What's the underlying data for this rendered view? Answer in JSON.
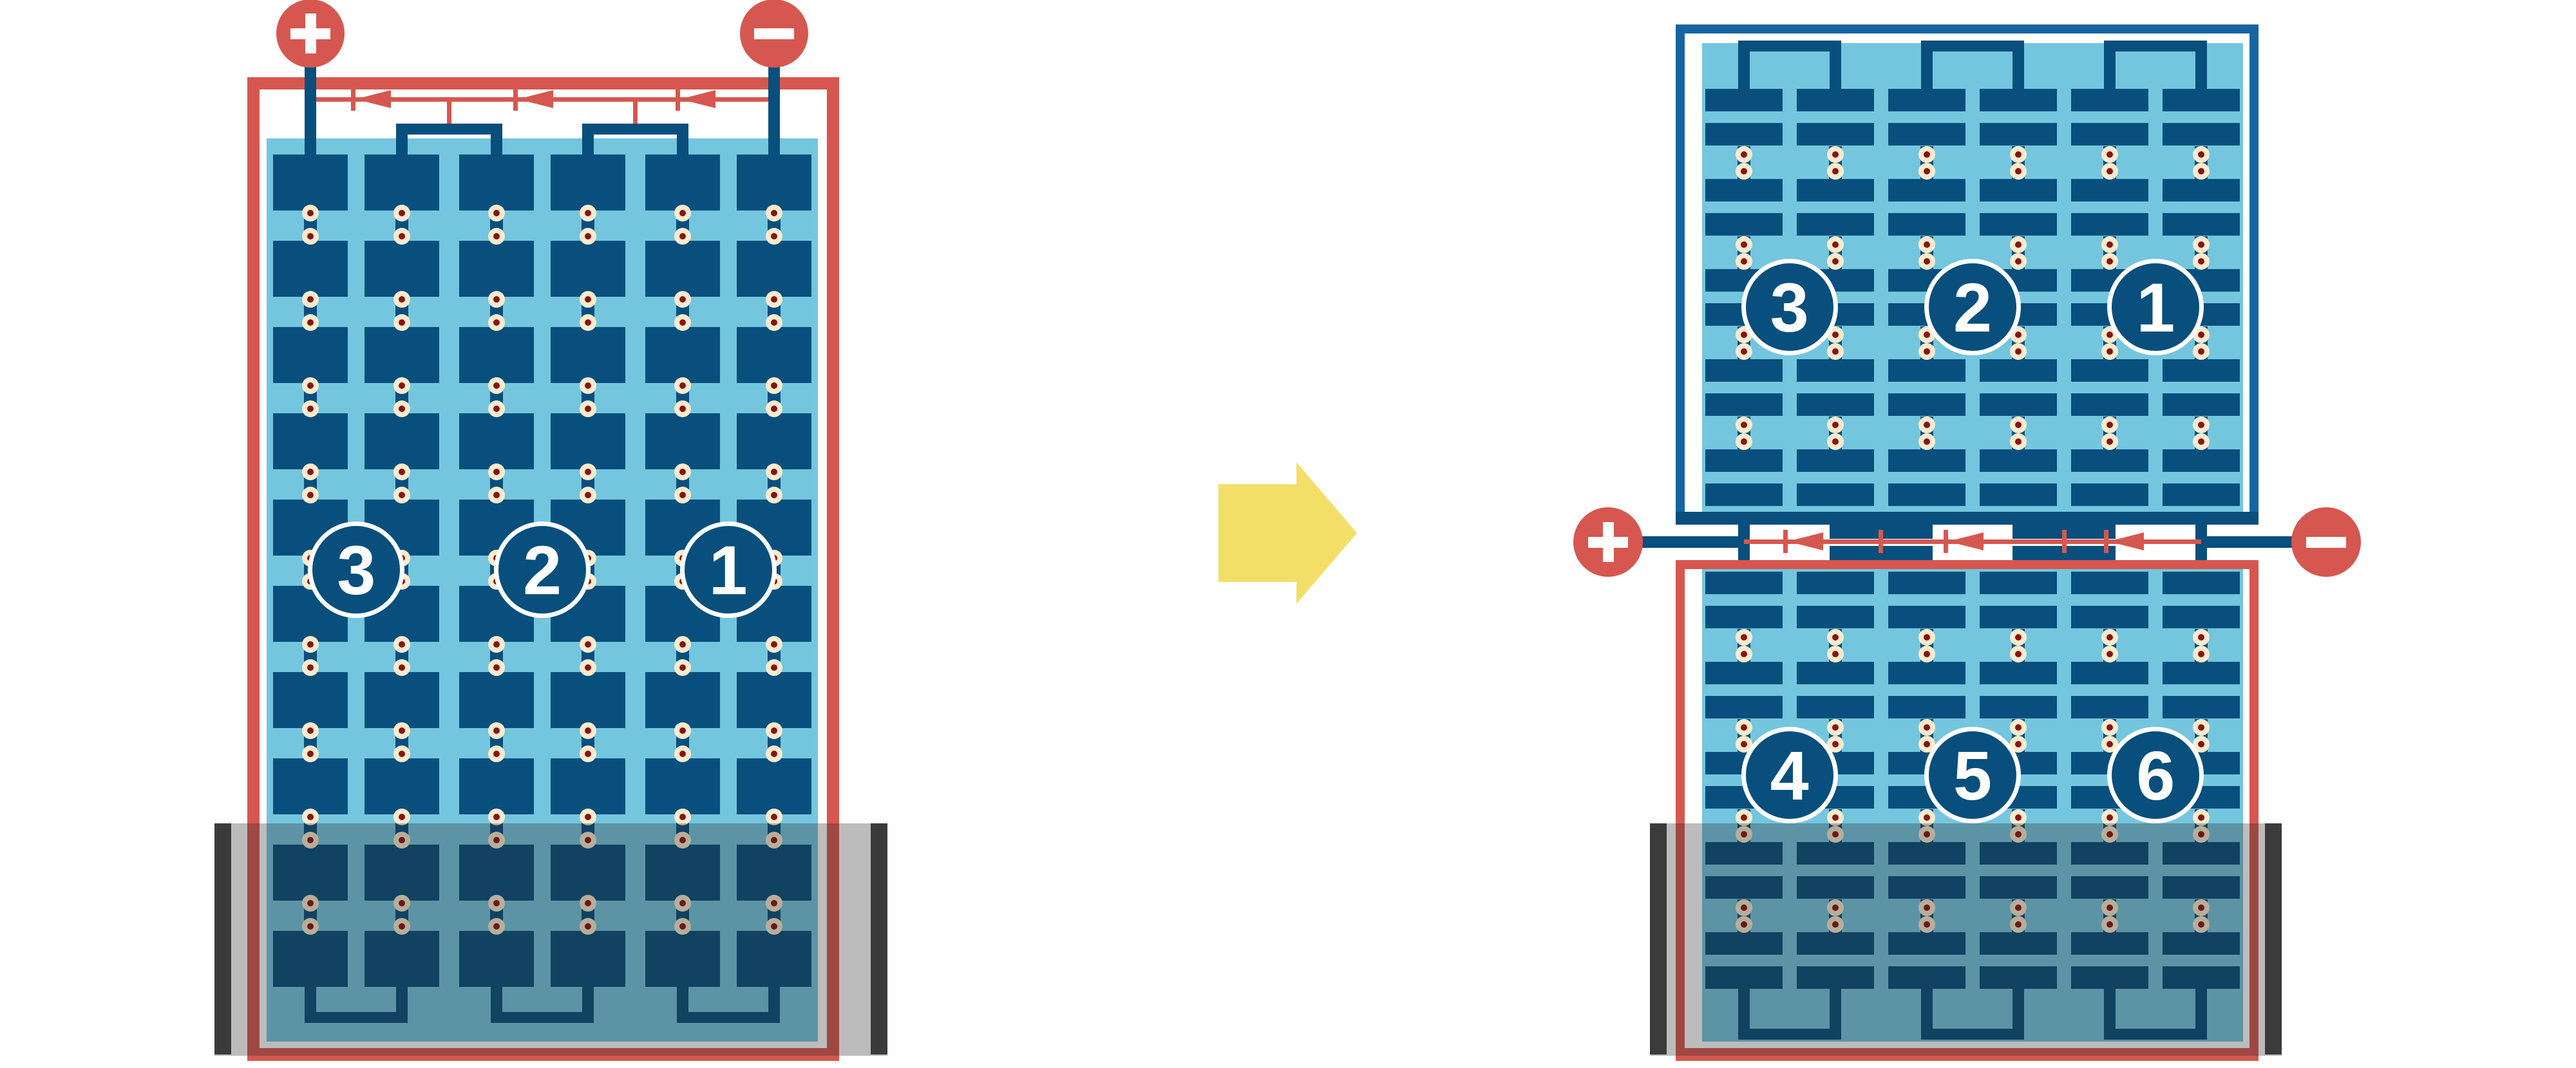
{
  "diagram": {
    "title": "Solar module bypass-diode shading comparison",
    "colors": {
      "red": "#D6574F",
      "navy": "#084F7D",
      "frame_blue": "#1565A3",
      "light_blue": "#74C6DE",
      "cream": "#F8EBCE",
      "maroon": "#8B1212",
      "yellow": "#F3DF68",
      "shade_bar": "#3B3B3B",
      "shade_overlay": "rgba(40,40,40,0.31)",
      "white": "#FFFFFF"
    },
    "left_module": {
      "type": "full-cell module",
      "positive_label": "+",
      "negative_label": "−",
      "string_numbers": [
        "3",
        "2",
        "1"
      ],
      "bypass_diodes": 3
    },
    "arrow": {
      "direction": "right"
    },
    "right_assembly": {
      "top_module": {
        "type": "half-cut module (upper half)",
        "string_numbers": [
          "3",
          "2",
          "1"
        ]
      },
      "junction": {
        "positive_label": "+",
        "negative_label": "−",
        "bypass_diodes": 3
      },
      "bottom_module": {
        "type": "half-cut module (lower half)",
        "string_numbers": [
          "4",
          "5",
          "6"
        ]
      }
    }
  }
}
